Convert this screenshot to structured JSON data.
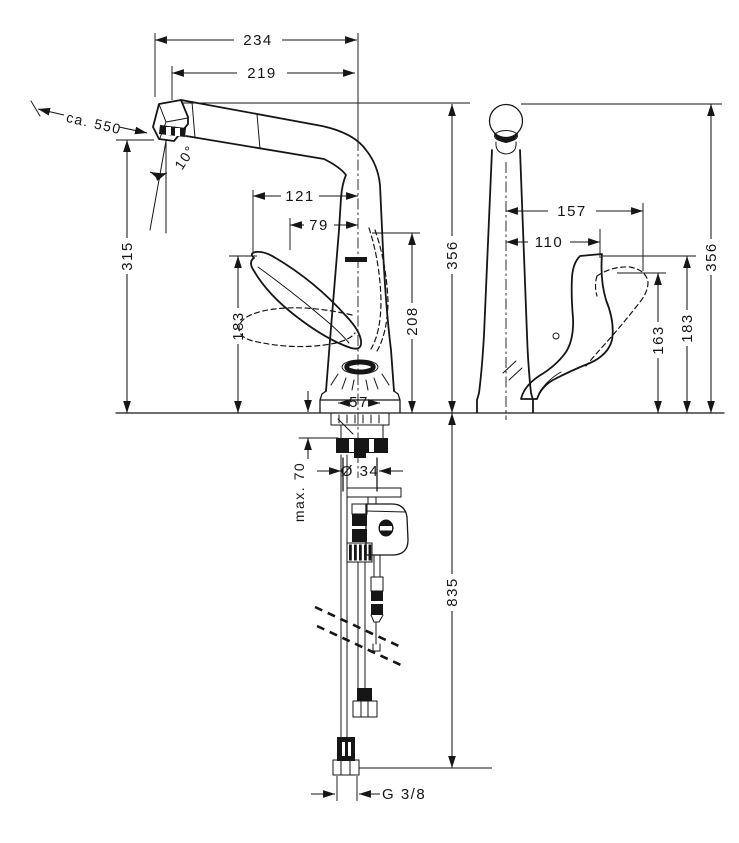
{
  "drawing": {
    "subject": "kitchen-faucet-dimension-drawing",
    "background": "#ffffff",
    "line_color": "#161616",
    "side_view": {
      "width_overall": "234",
      "spout_reach": "219",
      "pullout_length": "ca. 550",
      "spray_angle": "10°",
      "handle_reach": "121",
      "handle_front_offset": "79",
      "spout_height": "315",
      "handle_height": "183",
      "upper_body_height": "208",
      "total_height": "356",
      "base_width": "57",
      "max_counter_thickness": "max. 70",
      "shank_diameter": "Ø 34",
      "hose_length": "835",
      "connection_thread": "G 3/8"
    },
    "front_view": {
      "handle_reach_open": "157",
      "handle_reach": "110",
      "handle_height_open": "163",
      "handle_height": "183",
      "total_height": "356"
    }
  }
}
